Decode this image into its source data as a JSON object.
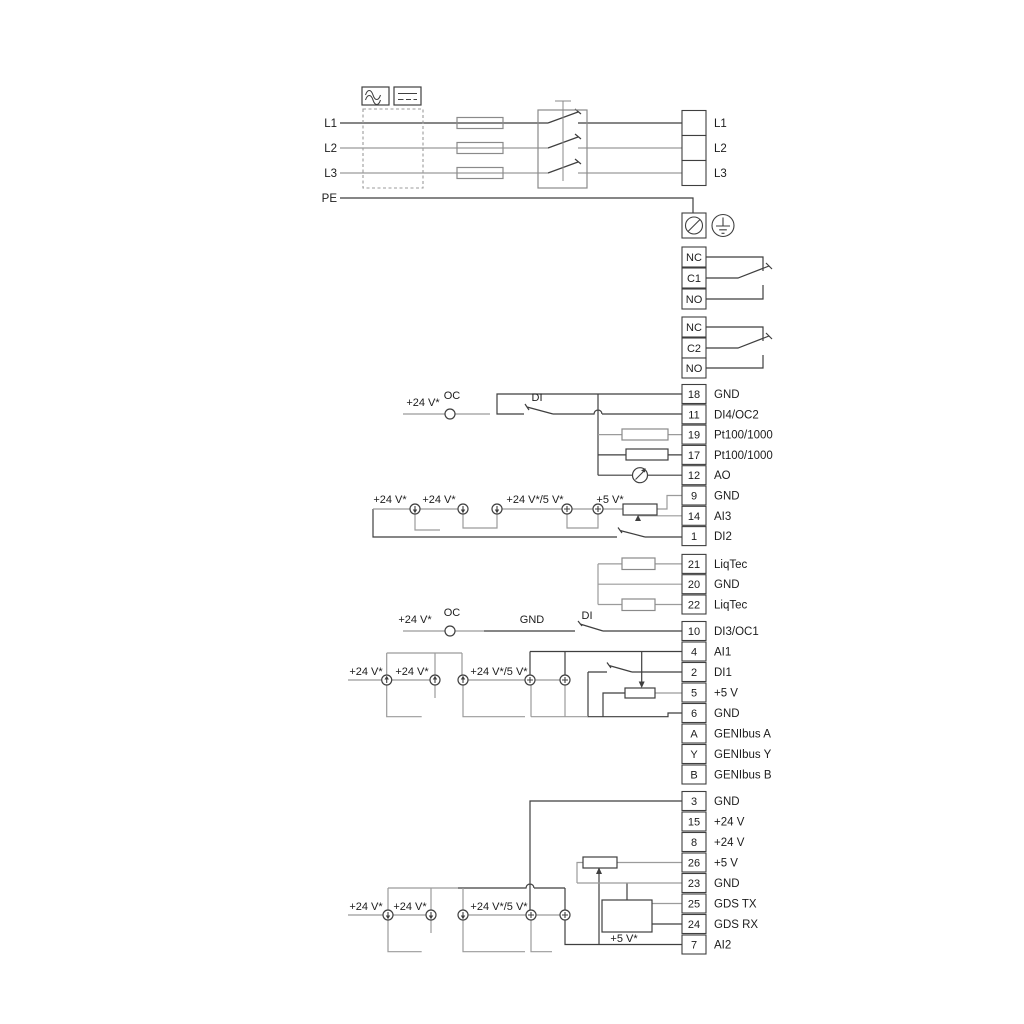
{
  "diagram": {
    "power_in": {
      "l1": "L1",
      "l2": "L2",
      "l3": "L3",
      "pe": "PE"
    },
    "power_out": {
      "l1": "L1",
      "l2": "L2",
      "l3": "L3"
    },
    "relay1": {
      "nc": "NC",
      "c": "C1",
      "no": "NO"
    },
    "relay2": {
      "nc": "NC",
      "c": "C2",
      "no": "NO"
    },
    "io_group1": [
      {
        "num": "18",
        "label": "GND"
      },
      {
        "num": "11",
        "label": "DI4/OC2"
      },
      {
        "num": "19",
        "label": "Pt100/1000"
      },
      {
        "num": "17",
        "label": "Pt100/1000"
      },
      {
        "num": "12",
        "label": "AO"
      },
      {
        "num": "9",
        "label": "GND"
      },
      {
        "num": "14",
        "label": "AI3"
      },
      {
        "num": "1",
        "label": "DI2"
      }
    ],
    "liqtec_group": [
      {
        "num": "21",
        "label": "LiqTec"
      },
      {
        "num": "20",
        "label": "GND"
      },
      {
        "num": "22",
        "label": "LiqTec"
      }
    ],
    "io_group2": [
      {
        "num": "10",
        "label": "DI3/OC1"
      },
      {
        "num": "4",
        "label": "AI1"
      },
      {
        "num": "2",
        "label": "DI1"
      },
      {
        "num": "5",
        "label": "+5 V"
      },
      {
        "num": "6",
        "label": "GND"
      },
      {
        "num": "A",
        "label": "GENIbus A"
      },
      {
        "num": "Y",
        "label": "GENIbus Y"
      },
      {
        "num": "B",
        "label": "GENIbus B"
      }
    ],
    "io_group3": [
      {
        "num": "3",
        "label": "GND"
      },
      {
        "num": "15",
        "label": "+24 V"
      },
      {
        "num": "8",
        "label": "+24 V"
      },
      {
        "num": "26",
        "label": "+5 V"
      },
      {
        "num": "23",
        "label": "GND"
      },
      {
        "num": "25",
        "label": "GDS TX"
      },
      {
        "num": "24",
        "label": "GDS RX"
      },
      {
        "num": "7",
        "label": "AI2"
      }
    ],
    "inline_labels": {
      "v24_top": "+24 V*",
      "oc_top": "OC",
      "di_top": "DI",
      "a_v24_1": "+24 V*",
      "a_v24_2": "+24 V*",
      "a_v24v5": "+24 V*/5 V*",
      "a_v5": "+5 V*",
      "v24_mid": "+24 V*",
      "oc_mid": "OC",
      "gnd_mid": "GND",
      "di_mid": "DI",
      "b_v24_1": "+24 V*",
      "b_v24_2": "+24 V*",
      "b_v24v5": "+24 V*/5 V*",
      "c_v24_1": "+24 V*",
      "c_v24_2": "+24 V*",
      "c_v24v5": "+24 V*/5 V*",
      "c_v5": "+5 V*"
    },
    "colors": {
      "line_dark": "#3f3f3f",
      "line_gray": "#9b9b9b",
      "text": "#1c1c1c",
      "background": "#ffffff"
    }
  }
}
